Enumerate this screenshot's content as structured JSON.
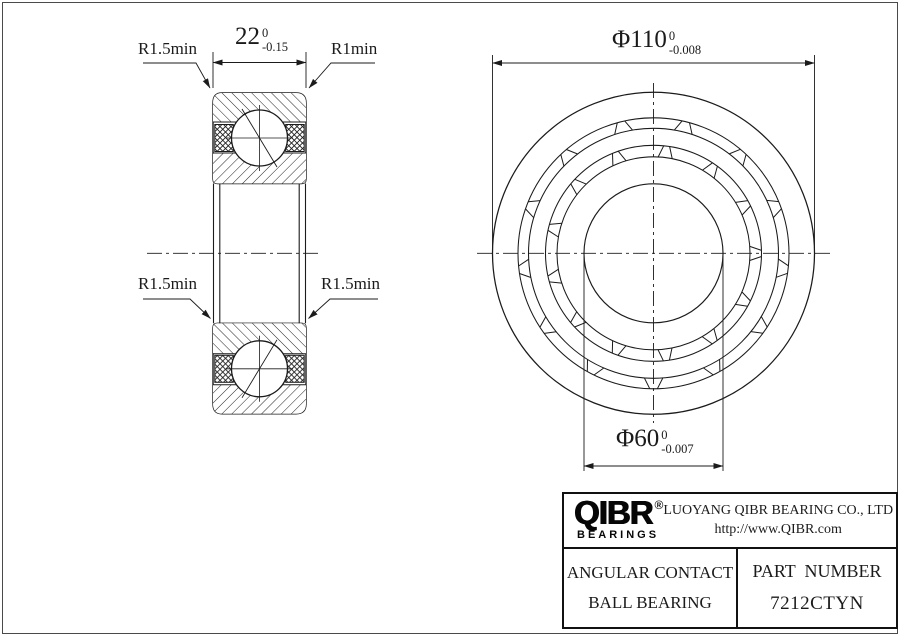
{
  "section_view": {
    "radius_top_left": "R1.5min",
    "radius_top_right": "R1min",
    "radius_mid_left": "R1.5min",
    "radius_mid_right": "R1.5min",
    "width_dim": {
      "value": "22",
      "tol_upper": "0",
      "tol_lower": "-0.15"
    }
  },
  "front_view": {
    "outer_dia": {
      "value": "Φ110",
      "tol_upper": "0",
      "tol_lower": "-0.008"
    },
    "bore_dia": {
      "value": "Φ60",
      "tol_upper": "0",
      "tol_lower": "-0.007"
    }
  },
  "title_block": {
    "brand": "QIBR",
    "registered": "®",
    "brand_sub": "BEARINGS",
    "company": "LUOYANG QIBR BEARING CO., LTD",
    "website": "http://www.QIBR.com",
    "product_line1": "ANGULAR CONTACT",
    "product_line2": "BALL BEARING",
    "part_label": "PART  NUMBER",
    "part_number": "7212CTYN"
  },
  "colors": {
    "line": "#1b1b1b",
    "background": "#ffffff"
  }
}
